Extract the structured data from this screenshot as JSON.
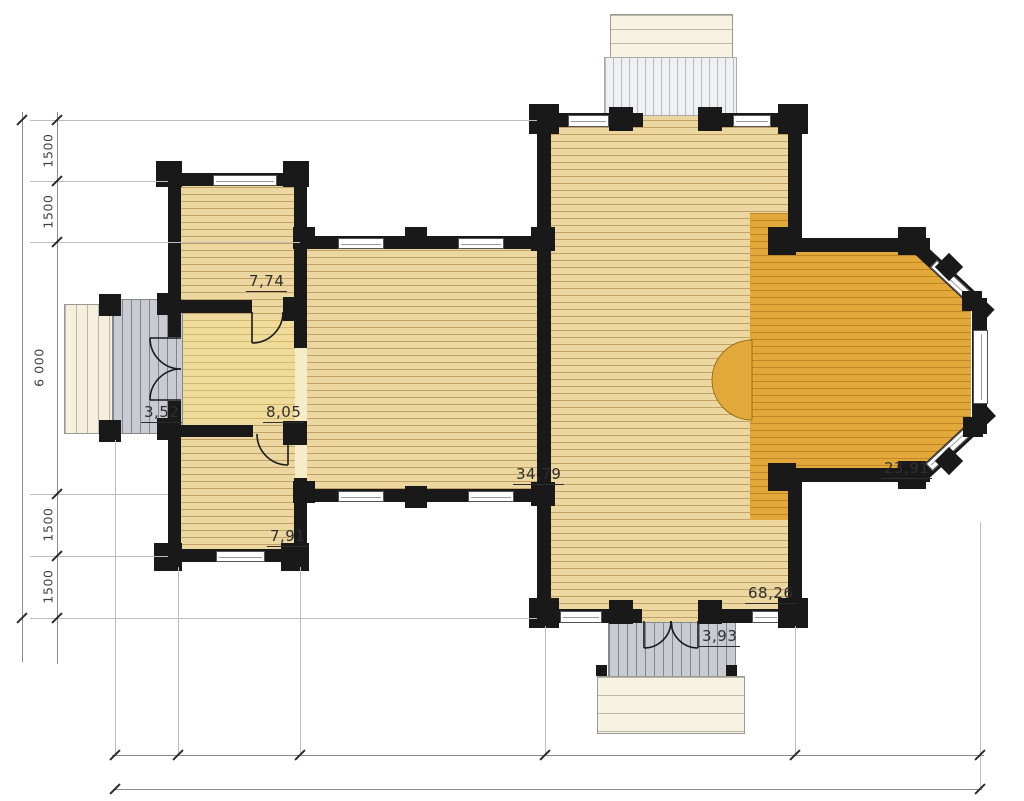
{
  "plan": {
    "rooms": [
      {
        "key": "annex-top-room",
        "area": "7,74"
      },
      {
        "key": "entry-porch",
        "area": "3,52"
      },
      {
        "key": "annex-hall-room",
        "area": "8,05"
      },
      {
        "key": "annex-bottom-room",
        "area": "7,91"
      },
      {
        "key": "living-wing",
        "area": "34,79"
      },
      {
        "key": "veranda-bay",
        "area": "23,91"
      },
      {
        "key": "main-hall",
        "area": "68,26"
      },
      {
        "key": "rear-porch",
        "area": "3,93"
      }
    ],
    "dimensions": {
      "left_chain": [
        "1500",
        "1500",
        "6 000",
        "1500",
        "1500"
      ]
    },
    "colors": {
      "floor": "#ecd7a1",
      "veranda_floor": "#e2a83a",
      "wall": "#191919",
      "deck": "#c8ccd2"
    }
  }
}
